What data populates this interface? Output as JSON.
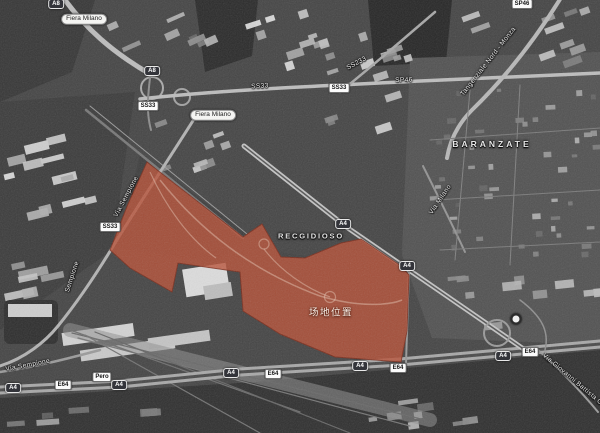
{
  "map": {
    "site_overlay": {
      "label": "场地位置",
      "label_x": 331,
      "label_y": 313,
      "fill_color": "#b85238",
      "border_color": "#7a2d1c"
    },
    "place_labels": [
      {
        "name": "fiera-milano-label-top",
        "text": "Fiera Milano",
        "x": 84,
        "y": 19,
        "style": "pill"
      },
      {
        "name": "fiera-milano-label",
        "text": "Fiera Milano",
        "x": 213,
        "y": 115,
        "style": "pill"
      },
      {
        "name": "baranzate-label",
        "text": "BARANZATE",
        "x": 492,
        "y": 144,
        "style": "town"
      },
      {
        "name": "recgidioso-label",
        "text": "RECGIDIOSO",
        "x": 311,
        "y": 236,
        "style": "district"
      }
    ],
    "road_names": [
      {
        "name": "road-name-ss33",
        "text": "SS33",
        "x": 260,
        "y": 87,
        "rot": -3
      },
      {
        "name": "road-name-ss233",
        "text": "SS233",
        "x": 357,
        "y": 64,
        "rot": -28
      },
      {
        "name": "road-name-sp46",
        "text": "SP46",
        "x": 404,
        "y": 81,
        "rot": -2
      },
      {
        "name": "road-name-tangenziale-nord-monza",
        "text": "Tangenziale Nord - Monza",
        "x": 489,
        "y": 62,
        "rot": -52
      },
      {
        "name": "road-name-via-sempione-upper",
        "text": "Via Sempione",
        "x": 127,
        "y": 197,
        "rot": -62
      },
      {
        "name": "road-name-sempione",
        "text": "Sempione",
        "x": 73,
        "y": 277,
        "rot": -72
      },
      {
        "name": "road-name-via-milano",
        "text": "Via Milano",
        "x": 441,
        "y": 200,
        "rot": -56
      },
      {
        "name": "road-name-via-sempione-bottom",
        "text": "Via Sempione",
        "x": 28,
        "y": 366,
        "rot": -11
      },
      {
        "name": "road-name-via-giovanni-battista",
        "text": "Via Giovanni Battista Grassi",
        "x": 578,
        "y": 385,
        "rot": 40
      }
    ],
    "road_badges": [
      {
        "name": "badge-a8-top",
        "text": "A8",
        "x": 56,
        "y": 4,
        "kind": "shield"
      },
      {
        "name": "badge-a8-interchange",
        "text": "A8",
        "x": 152,
        "y": 71,
        "kind": "shield"
      },
      {
        "name": "badge-ss33-fiera",
        "text": "SS33",
        "x": 148,
        "y": 106,
        "kind": "box"
      },
      {
        "name": "badge-ss33-center",
        "text": "SS33",
        "x": 339,
        "y": 88,
        "kind": "box"
      },
      {
        "name": "badge-ss33-sempione",
        "text": "SS33",
        "x": 110,
        "y": 227,
        "kind": "box"
      },
      {
        "name": "badge-sp46-top",
        "text": "SP46",
        "x": 522,
        "y": 4,
        "kind": "box"
      },
      {
        "name": "badge-a4-northeast-1",
        "text": "A4",
        "x": 343,
        "y": 224,
        "kind": "shield"
      },
      {
        "name": "badge-a4-northeast-2",
        "text": "A4",
        "x": 407,
        "y": 266,
        "kind": "shield"
      },
      {
        "name": "badge-a4-south-1",
        "text": "A4",
        "x": 13,
        "y": 388,
        "kind": "shield"
      },
      {
        "name": "badge-e64-1",
        "text": "E64",
        "x": 63,
        "y": 385,
        "kind": "box"
      },
      {
        "name": "badge-pero",
        "text": "Pero",
        "x": 102,
        "y": 377,
        "kind": "box"
      },
      {
        "name": "badge-a4-south-2",
        "text": "A4",
        "x": 119,
        "y": 385,
        "kind": "shield"
      },
      {
        "name": "badge-a4-south-3",
        "text": "A4",
        "x": 231,
        "y": 373,
        "kind": "shield"
      },
      {
        "name": "badge-e64-2",
        "text": "E64",
        "x": 273,
        "y": 374,
        "kind": "box"
      },
      {
        "name": "badge-a4-south-4",
        "text": "A4",
        "x": 360,
        "y": 366,
        "kind": "shield"
      },
      {
        "name": "badge-e64-3",
        "text": "E64",
        "x": 398,
        "y": 368,
        "kind": "box"
      },
      {
        "name": "badge-a4-south-5",
        "text": "A4",
        "x": 503,
        "y": 356,
        "kind": "shield"
      },
      {
        "name": "badge-e64-4",
        "text": "E64",
        "x": 530,
        "y": 352,
        "kind": "box"
      }
    ],
    "icons": [
      {
        "name": "metro-station-icon",
        "x": 516,
        "y": 319
      }
    ]
  }
}
